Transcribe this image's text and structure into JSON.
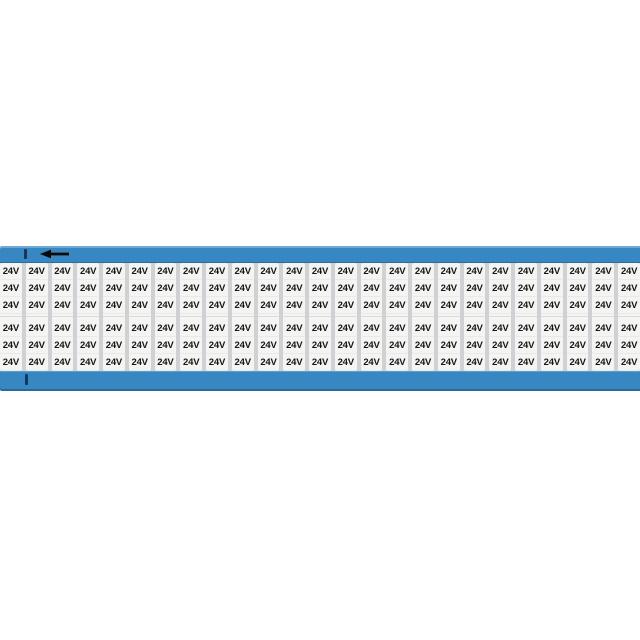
{
  "page": {
    "background": "#ffffff"
  },
  "card": {
    "type": "wire-marker-card",
    "label": "24V",
    "columns": 25,
    "groups": 2,
    "rows_per_group": 3,
    "total_labels": 150,
    "orientation_arrow_direction": "left",
    "colors": {
      "card_blue": "#3787c3",
      "label_bg": "#f4f4f2",
      "column_gap_gray": "#ced2d2",
      "label_text": "#161616",
      "registration_tick": "#16365e",
      "arrow": "#0b0b0b"
    }
  }
}
